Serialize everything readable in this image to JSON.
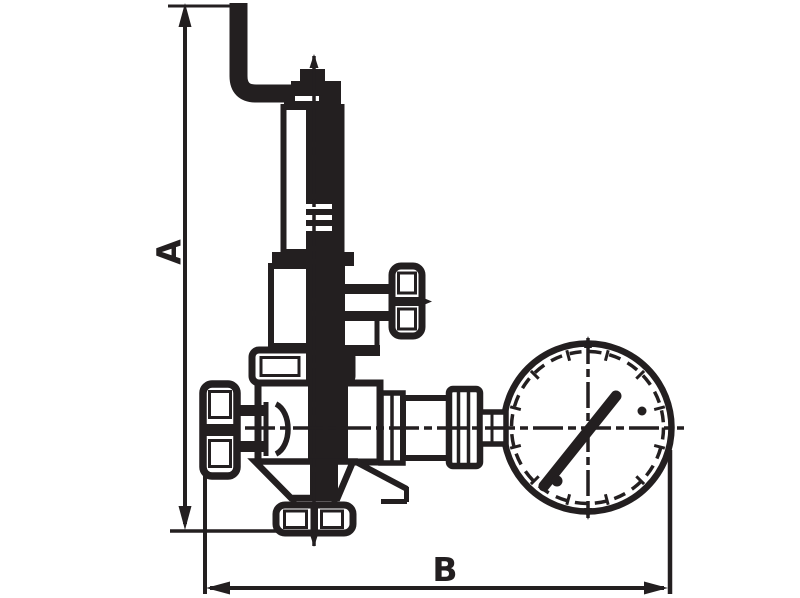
{
  "canvas": {
    "width": 800,
    "height": 598,
    "background": "#ffffff",
    "line_color": "#231f20"
  },
  "dimensions": {
    "a_label": "A",
    "b_label": "B"
  }
}
